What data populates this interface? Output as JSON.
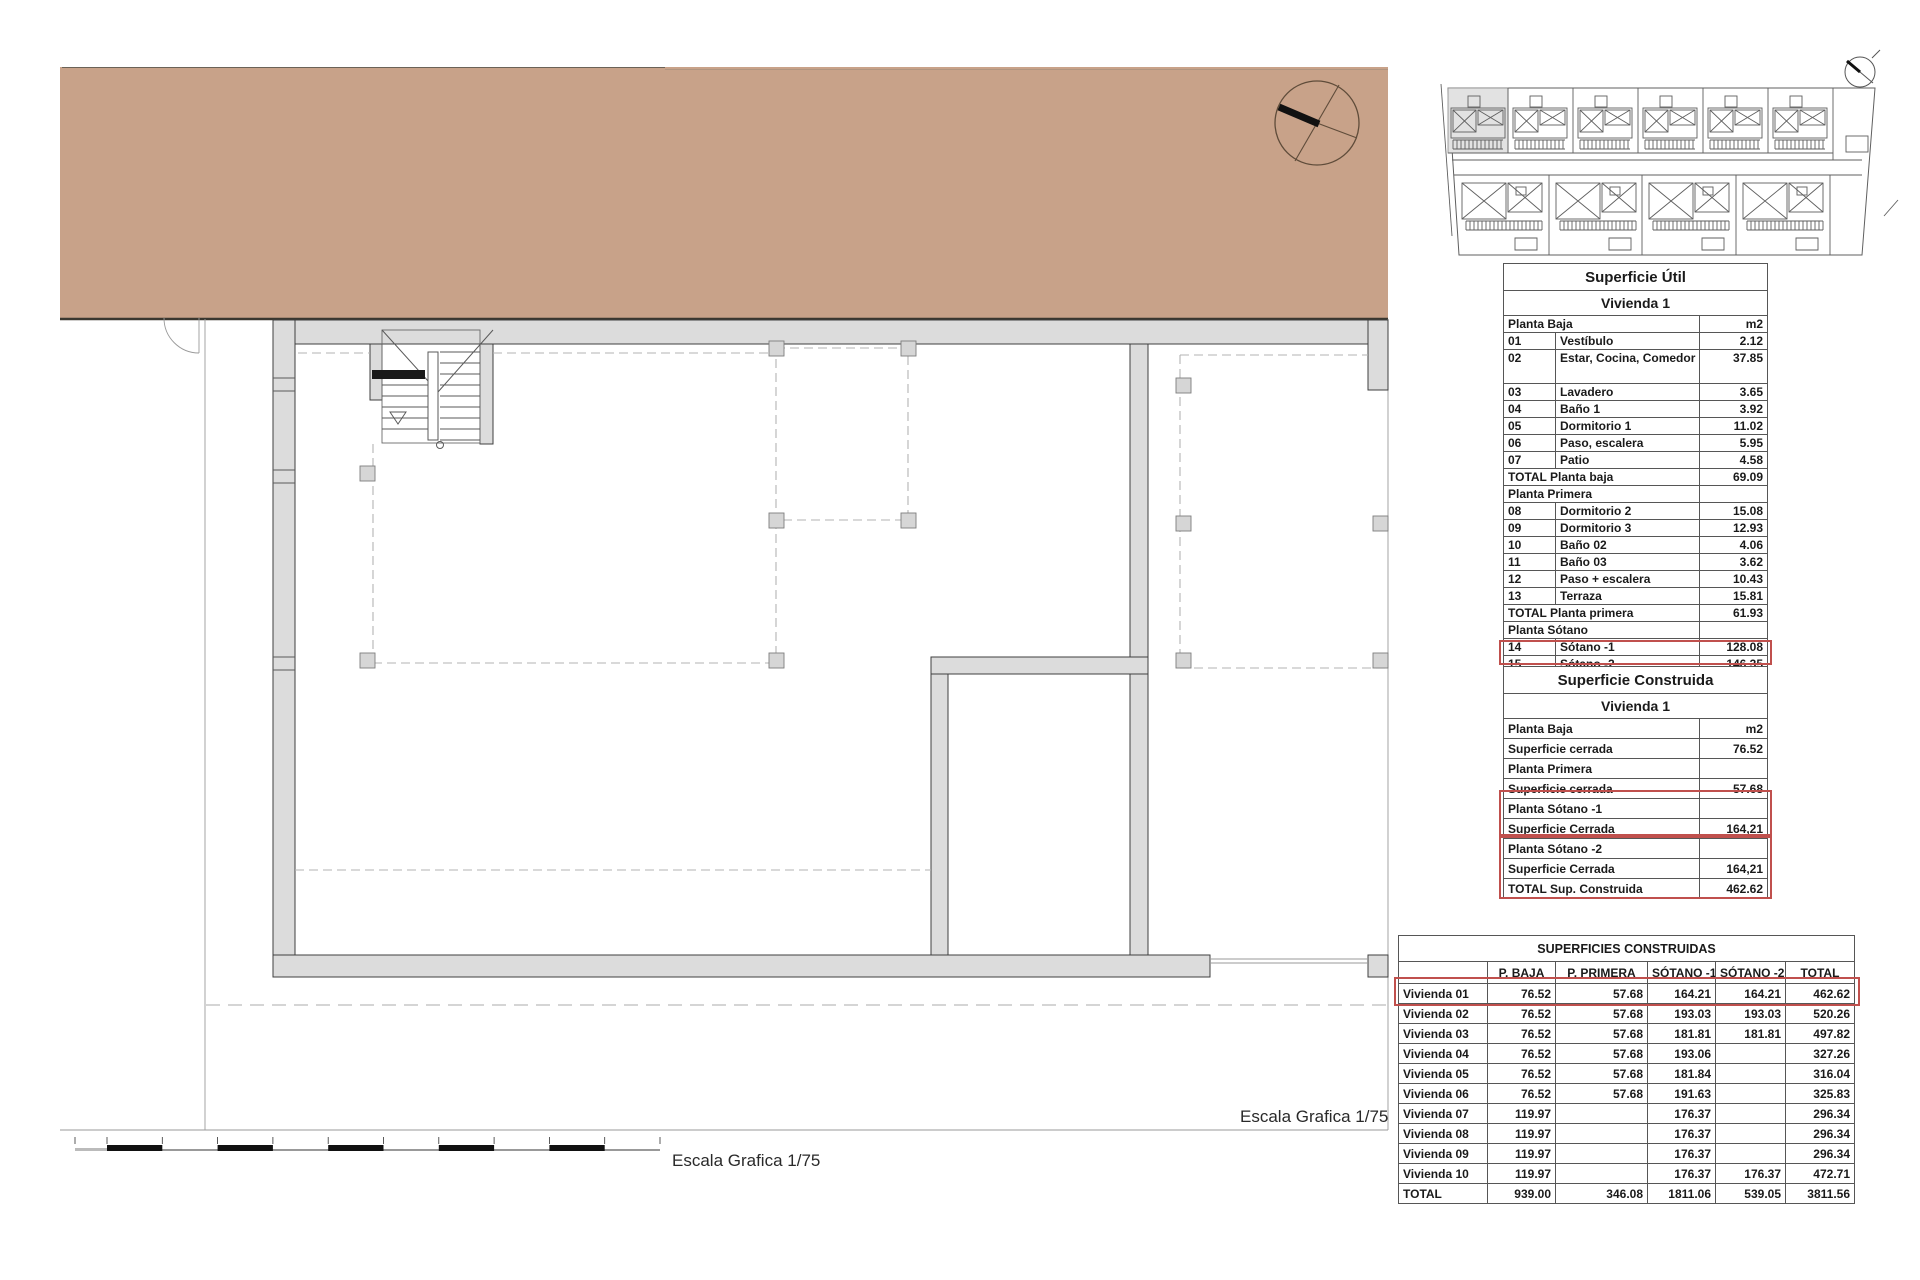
{
  "colors": {
    "terrain_tan": "#c8a289",
    "wall_gray": "#dcdcdc",
    "highlight_red": "#c0504d",
    "site_highlight_gray": "#e2e2e2"
  },
  "floorplan": {
    "scale_label_plan": "Escala Grafica 1/75",
    "scale_label_bottom": "Escala Grafica 1/75"
  },
  "icons": {
    "north_compass": "compass-circle-with-needle",
    "site_mini_compass": "compass-circle-small",
    "stair": "staircase-with-down-arrow"
  },
  "util_table": {
    "title": "Superficie Útil",
    "subtitle": "Vivienda 1",
    "rows": [
      {
        "cls": "head",
        "cells": [
          {
            "t": "Planta Baja",
            "cs": 2
          },
          {
            "t": "m2",
            "cls": "r"
          }
        ]
      },
      {
        "cells": [
          {
            "t": "01"
          },
          {
            "t": "Vestíbulo"
          },
          {
            "t": "2.12",
            "cls": "r"
          }
        ]
      },
      {
        "cls": "tall",
        "cells": [
          {
            "t": "02"
          },
          {
            "t": "Estar, Cocina, Comedor"
          },
          {
            "t": "37.85",
            "cls": "r"
          }
        ]
      },
      {
        "cells": [
          {
            "t": "03"
          },
          {
            "t": "Lavadero"
          },
          {
            "t": "3.65",
            "cls": "r"
          }
        ]
      },
      {
        "cells": [
          {
            "t": "04"
          },
          {
            "t": "Baño 1"
          },
          {
            "t": "3.92",
            "cls": "r"
          }
        ]
      },
      {
        "cells": [
          {
            "t": "05"
          },
          {
            "t": "Dormitorio 1"
          },
          {
            "t": "11.02",
            "cls": "r"
          }
        ]
      },
      {
        "cells": [
          {
            "t": "06"
          },
          {
            "t": "Paso, escalera"
          },
          {
            "t": "5.95",
            "cls": "r"
          }
        ]
      },
      {
        "cells": [
          {
            "t": "07"
          },
          {
            "t": "Patio"
          },
          {
            "t": "4.58",
            "cls": "r"
          }
        ]
      },
      {
        "cells": [
          {
            "t": "TOTAL Planta baja",
            "cs": 2
          },
          {
            "t": "69.09",
            "cls": "r"
          }
        ]
      },
      {
        "cls": "head",
        "cells": [
          {
            "t": "Planta Primera",
            "cs": 2
          },
          {
            "t": ""
          }
        ]
      },
      {
        "cells": [
          {
            "t": "08"
          },
          {
            "t": "Dormitorio 2"
          },
          {
            "t": "15.08",
            "cls": "r"
          }
        ]
      },
      {
        "cells": [
          {
            "t": "09"
          },
          {
            "t": "Dormitorio 3"
          },
          {
            "t": "12.93",
            "cls": "r"
          }
        ]
      },
      {
        "cells": [
          {
            "t": "10"
          },
          {
            "t": "Baño 02"
          },
          {
            "t": "4.06",
            "cls": "r"
          }
        ]
      },
      {
        "cells": [
          {
            "t": "11"
          },
          {
            "t": "Baño 03"
          },
          {
            "t": "3.62",
            "cls": "r"
          }
        ]
      },
      {
        "cells": [
          {
            "t": "12"
          },
          {
            "t": "Paso + escalera"
          },
          {
            "t": "10.43",
            "cls": "r"
          }
        ]
      },
      {
        "cells": [
          {
            "t": "13"
          },
          {
            "t": "Terraza"
          },
          {
            "t": "15.81",
            "cls": "r"
          }
        ]
      },
      {
        "cells": [
          {
            "t": "TOTAL Planta primera",
            "cs": 2
          },
          {
            "t": "61.93",
            "cls": "r"
          }
        ]
      },
      {
        "cls": "head",
        "cells": [
          {
            "t": "Planta Sótano",
            "cs": 2
          },
          {
            "t": ""
          }
        ]
      },
      {
        "name": "row-sotano-1",
        "cells": [
          {
            "t": "14"
          },
          {
            "t": "Sótano -1"
          },
          {
            "t": "128.08",
            "cls": "r"
          }
        ]
      },
      {
        "cells": [
          {
            "t": "15"
          },
          {
            "t": "Sótano -2"
          },
          {
            "t": "146.35",
            "cls": "r"
          }
        ]
      },
      {
        "cells": [
          {
            "t": "TOTAL",
            "cs": 2
          },
          {
            "t": "405.45",
            "cls": "r"
          }
        ]
      }
    ]
  },
  "cons_table": {
    "title": "Superficie Construida",
    "subtitle": "Vivienda 1",
    "rows": [
      {
        "cls": "head",
        "cells": [
          {
            "t": "Planta Baja"
          },
          {
            "t": "m2",
            "cls": "r"
          }
        ]
      },
      {
        "cells": [
          {
            "t": "Superficie cerrada"
          },
          {
            "t": "76.52",
            "cls": "r"
          }
        ]
      },
      {
        "cls": "head",
        "cells": [
          {
            "t": "Planta Primera"
          },
          {
            "t": ""
          }
        ]
      },
      {
        "cells": [
          {
            "t": "Superficie cerrada"
          },
          {
            "t": "57.68",
            "cls": "r"
          }
        ]
      },
      {
        "cls": "head",
        "name": "row-planta-sotano-1",
        "cells": [
          {
            "t": "Planta Sótano -1"
          },
          {
            "t": ""
          }
        ]
      },
      {
        "name": "row-sup-cerrada-sotano-1",
        "cells": [
          {
            "t": "Superficie Cerrada"
          },
          {
            "t": "164,21",
            "cls": "r"
          }
        ]
      },
      {
        "cls": "head",
        "cells": [
          {
            "t": "Planta Sótano -2"
          },
          {
            "t": ""
          }
        ]
      },
      {
        "cells": [
          {
            "t": "Superficie Cerrada"
          },
          {
            "t": "164,21",
            "cls": "r"
          }
        ]
      },
      {
        "cells": [
          {
            "t": "TOTAL Sup. Construida"
          },
          {
            "t": "462.62",
            "cls": "r"
          }
        ]
      }
    ]
  },
  "sums_table": {
    "title": "SUPERFICIES CONSTRUIDAS",
    "rows": [
      {
        "cls": "hdr",
        "cells": [
          {
            "t": ""
          },
          {
            "t": "P. BAJA"
          },
          {
            "t": "P. PRIMERA"
          },
          {
            "t": "SÓTANO -1"
          },
          {
            "t": "SÓTANO -2"
          },
          {
            "t": "TOTAL"
          }
        ]
      },
      {
        "name": "row-vivienda-01",
        "cells": [
          {
            "t": "Vivienda 01"
          },
          {
            "t": "76.52",
            "cls": "r"
          },
          {
            "t": "57.68",
            "cls": "r"
          },
          {
            "t": "164.21",
            "cls": "r"
          },
          {
            "t": "164.21",
            "cls": "r"
          },
          {
            "t": "462.62",
            "cls": "r"
          }
        ]
      },
      {
        "cells": [
          {
            "t": "Vivienda 02"
          },
          {
            "t": "76.52",
            "cls": "r"
          },
          {
            "t": "57.68",
            "cls": "r"
          },
          {
            "t": "193.03",
            "cls": "r"
          },
          {
            "t": "193.03",
            "cls": "r"
          },
          {
            "t": "520.26",
            "cls": "r"
          }
        ]
      },
      {
        "cells": [
          {
            "t": "Vivienda 03"
          },
          {
            "t": "76.52",
            "cls": "r"
          },
          {
            "t": "57.68",
            "cls": "r"
          },
          {
            "t": "181.81",
            "cls": "r"
          },
          {
            "t": "181.81",
            "cls": "r"
          },
          {
            "t": "497.82",
            "cls": "r"
          }
        ]
      },
      {
        "cells": [
          {
            "t": "Vivienda 04"
          },
          {
            "t": "76.52",
            "cls": "r"
          },
          {
            "t": "57.68",
            "cls": "r"
          },
          {
            "t": "193.06",
            "cls": "r"
          },
          {
            "t": "",
            "cls": "r"
          },
          {
            "t": "327.26",
            "cls": "r"
          }
        ]
      },
      {
        "cells": [
          {
            "t": "Vivienda 05"
          },
          {
            "t": "76.52",
            "cls": "r"
          },
          {
            "t": "57.68",
            "cls": "r"
          },
          {
            "t": "181.84",
            "cls": "r"
          },
          {
            "t": "",
            "cls": "r"
          },
          {
            "t": "316.04",
            "cls": "r"
          }
        ]
      },
      {
        "cells": [
          {
            "t": "Vivienda 06"
          },
          {
            "t": "76.52",
            "cls": "r"
          },
          {
            "t": "57.68",
            "cls": "r"
          },
          {
            "t": "191.63",
            "cls": "r"
          },
          {
            "t": "",
            "cls": "r"
          },
          {
            "t": "325.83",
            "cls": "r"
          }
        ]
      },
      {
        "cells": [
          {
            "t": "Vivienda 07"
          },
          {
            "t": "119.97",
            "cls": "r"
          },
          {
            "t": "",
            "cls": "r"
          },
          {
            "t": "176.37",
            "cls": "r"
          },
          {
            "t": "",
            "cls": "r"
          },
          {
            "t": "296.34",
            "cls": "r"
          }
        ]
      },
      {
        "cells": [
          {
            "t": "Vivienda 08"
          },
          {
            "t": "119.97",
            "cls": "r"
          },
          {
            "t": "",
            "cls": "r"
          },
          {
            "t": "176.37",
            "cls": "r"
          },
          {
            "t": "",
            "cls": "r"
          },
          {
            "t": "296.34",
            "cls": "r"
          }
        ]
      },
      {
        "cells": [
          {
            "t": "Vivienda 09"
          },
          {
            "t": "119.97",
            "cls": "r"
          },
          {
            "t": "",
            "cls": "r"
          },
          {
            "t": "176.37",
            "cls": "r"
          },
          {
            "t": "",
            "cls": "r"
          },
          {
            "t": "296.34",
            "cls": "r"
          }
        ]
      },
      {
        "cells": [
          {
            "t": "Vivienda 10"
          },
          {
            "t": "119.97",
            "cls": "r"
          },
          {
            "t": "",
            "cls": "r"
          },
          {
            "t": "176.37",
            "cls": "r"
          },
          {
            "t": "176.37",
            "cls": "r"
          },
          {
            "t": "472.71",
            "cls": "r"
          }
        ]
      },
      {
        "cells": [
          {
            "t": "TOTAL"
          },
          {
            "t": "939.00",
            "cls": "r"
          },
          {
            "t": "346.08",
            "cls": "r"
          },
          {
            "t": "1811.06",
            "cls": "r"
          },
          {
            "t": "539.05",
            "cls": "r"
          },
          {
            "t": "3811.56",
            "cls": "r"
          }
        ]
      }
    ]
  }
}
